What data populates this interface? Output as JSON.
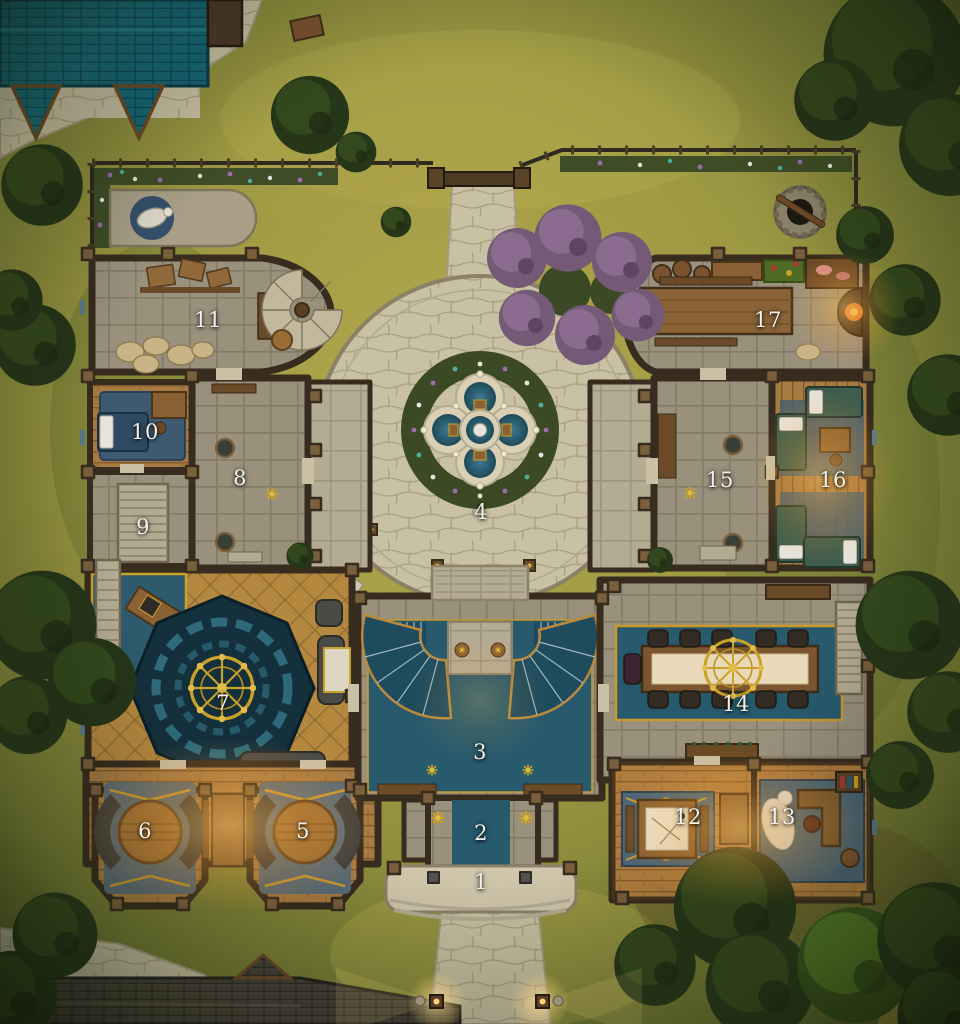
{
  "map": {
    "rooms": [
      {
        "number": "1",
        "x": 481,
        "y": 882
      },
      {
        "number": "2",
        "x": 481,
        "y": 833
      },
      {
        "number": "3",
        "x": 480,
        "y": 752
      },
      {
        "number": "4",
        "x": 481,
        "y": 512
      },
      {
        "number": "5",
        "x": 303,
        "y": 831
      },
      {
        "number": "6",
        "x": 145,
        "y": 831
      },
      {
        "number": "7",
        "x": 223,
        "y": 703
      },
      {
        "number": "8",
        "x": 240,
        "y": 478
      },
      {
        "number": "9",
        "x": 143,
        "y": 527
      },
      {
        "number": "10",
        "x": 145,
        "y": 432
      },
      {
        "number": "11",
        "x": 208,
        "y": 320
      },
      {
        "number": "12",
        "x": 688,
        "y": 817
      },
      {
        "number": "13",
        "x": 782,
        "y": 817
      },
      {
        "number": "14",
        "x": 736,
        "y": 704
      },
      {
        "number": "15",
        "x": 720,
        "y": 480
      },
      {
        "number": "16",
        "x": 833,
        "y": 480
      },
      {
        "number": "17",
        "x": 768,
        "y": 320
      }
    ],
    "features": [
      "fountain",
      "courtyard",
      "garden-fence",
      "gate",
      "statue-garden",
      "well",
      "stable-roof",
      "cottage-roof",
      "grand-staircase",
      "dining-hall",
      "mosaic-hall",
      "purple-blossom-trees",
      "path-lamps"
    ],
    "colors": {
      "grass_light": "#b4aa4e",
      "grass_dark": "#4f5c27",
      "tree_dark": "#263619",
      "tree_light": "#33491d",
      "stone_path": "#c9c1a3",
      "stone_floor": "#9a917d",
      "wood_floor": "#a87b42",
      "wall": "#372c1e",
      "water_teal": "#2b5d70",
      "carpet_teal": "#275a6d",
      "mosaic_dark": "#14303c",
      "gold": "#c9a227",
      "roof_teal": "#156878",
      "roof_dark": "#474239",
      "purple_tree": "#745a77",
      "rug_blue": "#4b6678",
      "glow_warm": "#ffbe5a",
      "marker_text": "#f3f1ea"
    }
  }
}
